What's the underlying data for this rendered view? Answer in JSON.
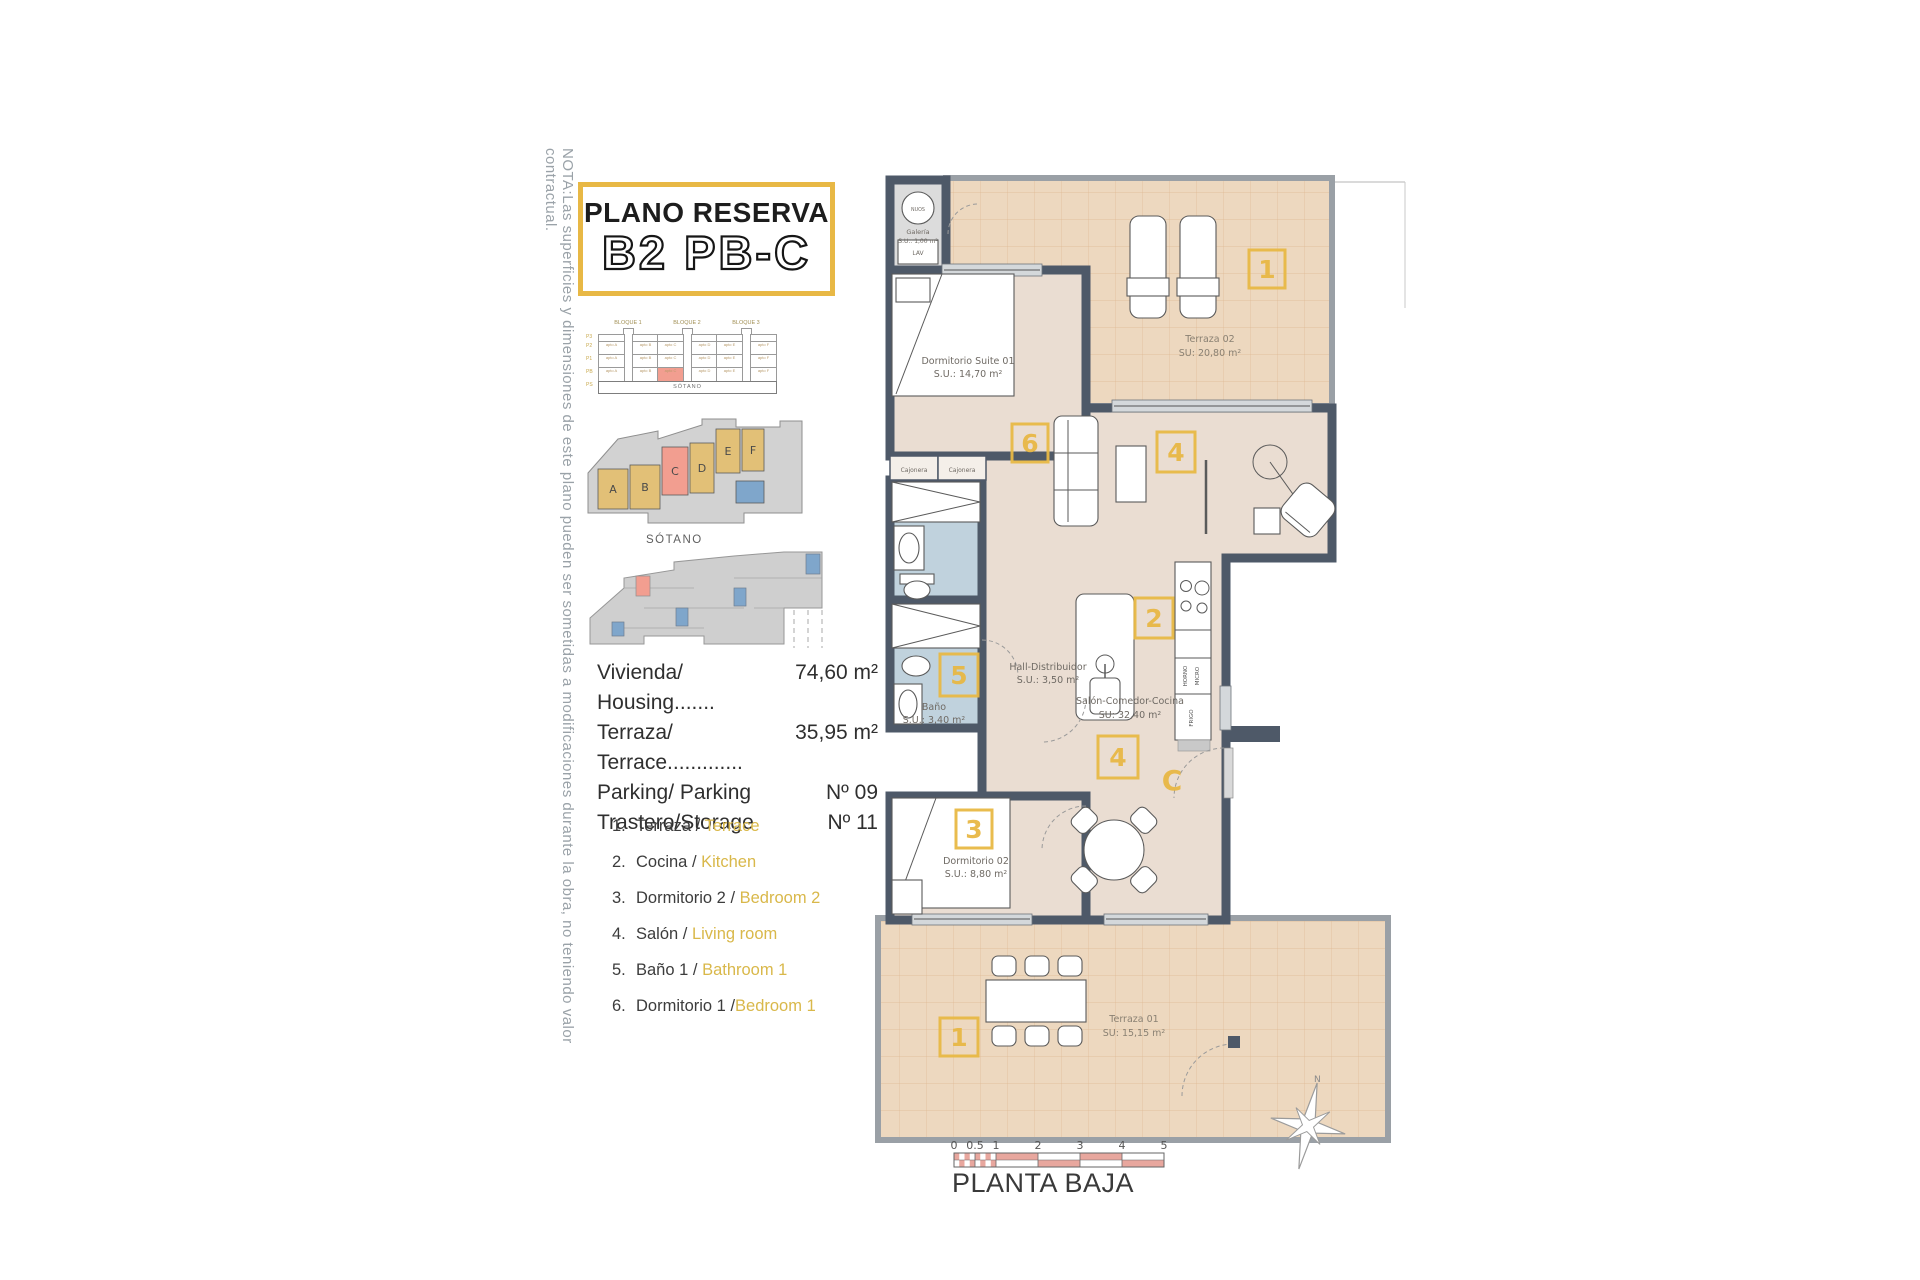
{
  "note_vertical": "NOTA:Las superficies y dimensiones de este plano pueden ser sometidas a modificaciones durante la obra, no teniendo valor contractual.",
  "title": {
    "line1": "PLANO RESERVA",
    "line2": "B2 PB-C"
  },
  "elevation": {
    "blocks": [
      "BLOQUE 1",
      "BLOQUE 2",
      "BLOQUE 3"
    ],
    "floors": [
      "P3",
      "P2",
      "P1",
      "PB",
      "PS"
    ],
    "rows": [
      [
        "apto A",
        "apto B",
        "apto C",
        "apto D",
        "apto E",
        "apto F"
      ],
      [
        "apto A",
        "apto B",
        "apto C",
        "apto D",
        "apto E",
        "apto F"
      ],
      [
        "apto A",
        "apto B",
        "apto C",
        "apto D",
        "apto E",
        "apto F"
      ]
    ],
    "basement": "SÓTANO"
  },
  "site_plan": {
    "units": [
      "A",
      "B",
      "C",
      "D",
      "E",
      "F"
    ],
    "basement_label": "SÓTANO"
  },
  "summary": {
    "rows": [
      {
        "label": "Vivienda/ Housing.......",
        "value": "74,60 m²"
      },
      {
        "label": "Terraza/ Terrace.............",
        "value": "35,95 m²"
      },
      {
        "label": "Parking/ Parking",
        "value": "Nº 09"
      },
      {
        "label": "Trastero/Storage",
        "value": "Nº 11"
      }
    ]
  },
  "legend": {
    "items": [
      {
        "num": "1.",
        "es": "Terraza / ",
        "en": "Terrace"
      },
      {
        "num": "2.",
        "es": "Cocina / ",
        "en": "Kitchen"
      },
      {
        "num": "3.",
        "es": "Dormitorio 2 / ",
        "en": "Bedroom 2"
      },
      {
        "num": "4.",
        "es": "Salón / ",
        "en": "Living room"
      },
      {
        "num": "5.",
        "es": "Baño 1 / ",
        "en": "Bathroom 1"
      },
      {
        "num": "6.",
        "es": "Dormitorio 1 /",
        "en": "Bedroom 1"
      }
    ]
  },
  "plan": {
    "galeria": {
      "device": "NUOS",
      "name": "Galería",
      "area": "S.U.: 1,00 m²",
      "appliance": "LAV"
    },
    "suite": {
      "name": "Dormitorio Suite 01",
      "area": "S.U.: 14,70 m²",
      "marker": "6"
    },
    "terraza2": {
      "name": "Terraza 02",
      "area": "SU: 20,80 m²",
      "marker": "1"
    },
    "cajonera_left": "Cajonera",
    "cajonera_right": "Cajonera",
    "bano": {
      "name": "Baño",
      "area": "S.U.: 3,40 m²",
      "marker": "5"
    },
    "hall": {
      "name": "Hall-Distribuidor",
      "area": "S.U.: 3,50 m²"
    },
    "salon": {
      "name": "Salón-Comedor-Cocina",
      "area": "SU: 32,40 m²",
      "marker_living": "4",
      "marker_kitchen": "2",
      "marker_door": "4"
    },
    "kitchen": {
      "oven": "HORNO",
      "micro": "MICRO",
      "fridge": "FRIGO"
    },
    "dorm2": {
      "name": "Dormitorio 02",
      "area": "S.U.: 8,80 m²",
      "marker": "3"
    },
    "terraza1": {
      "name": "Terraza 01",
      "area": "SU: 15,15 m²",
      "marker": "1"
    },
    "entrance_letter": "C"
  },
  "scale_bar": {
    "ticks": [
      "0",
      "0.5",
      "1",
      "2",
      "3",
      "4",
      "5"
    ]
  },
  "floor_label": "PLANTA BAJA",
  "compass_label": "N",
  "colors": {
    "accent": "#E8B845",
    "wall": "#4E5968",
    "interior": "#EADDD2",
    "terrace": "#EDD8BF",
    "bathroom": "#C0D2DD",
    "highlight": "#F29E90",
    "site_tan": "#E2C077",
    "site_blue": "#7FA6CB",
    "scale_red": "#E8A79E"
  }
}
